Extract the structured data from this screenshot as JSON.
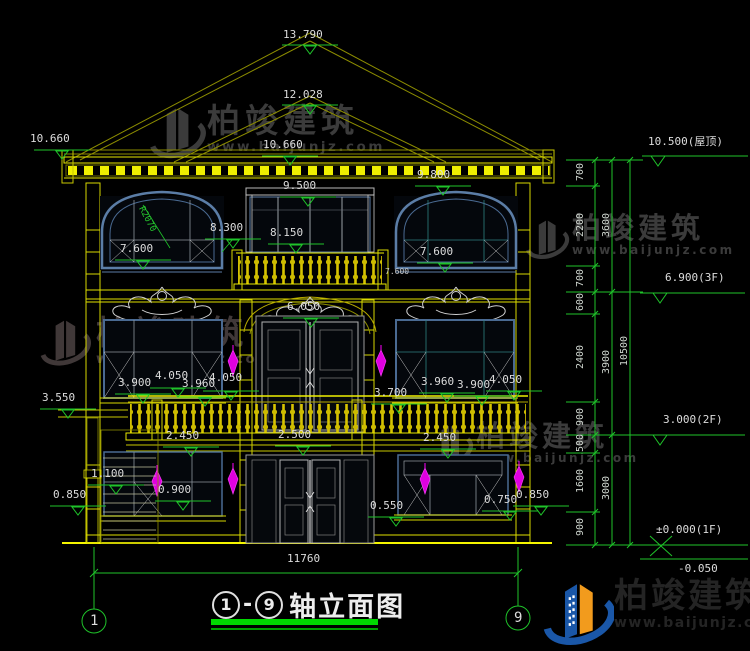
{
  "watermark": {
    "brand": "柏竣建筑",
    "url": "www.baijunjz.com"
  },
  "brand_footer": {
    "name": "柏竣建筑",
    "url": "www.baijunjz.com"
  },
  "title": {
    "axis_start": "1",
    "dash": "-",
    "axis_end": "9",
    "text": "轴立面图"
  },
  "axis_bubbles": {
    "left": "1",
    "right": "9"
  },
  "elevations": {
    "peak": "13.790",
    "ridge": "12.028",
    "eave_left": "10.660",
    "eave_center": "10.660",
    "v9800": "9.800",
    "v9500": "9.500",
    "v8300": "8.300",
    "v8150": "8.150",
    "v7600_left": "7.600",
    "v7600_right": "7.600",
    "v7600_small": "7.600",
    "v6050": "6.050",
    "radius_note": "R2070",
    "v3900_left": "3.900",
    "v4050_left": "4.050",
    "v3960_left": "3.960",
    "v4050_left2": "4.050",
    "v3700": "3.700",
    "v3960_right": "3.960",
    "v3900_right": "3.900",
    "v4050_right": "4.050",
    "v3550": "3.550",
    "v2450_left": "2.450",
    "v2500": "2.500",
    "v2450_right": "2.450",
    "v1100": "1.100",
    "v0850_left": "0.850",
    "v0900": "0.900",
    "v0550": "0.550",
    "v0750": "0.750",
    "v0850_right": "0.850"
  },
  "dimensions": {
    "overall_width": "11760",
    "right_chain": [
      "700",
      "2200",
      "700",
      "600",
      "2400",
      "900",
      "500",
      "1600",
      "900"
    ],
    "right_subtotals": [
      "3600",
      "3900",
      "3000"
    ],
    "right_total": "10500",
    "levels": {
      "roof": "10.500(屋顶)",
      "f3": "6.900(3F)",
      "f2": "3.000(2F)",
      "f1": "±0.000(1F)",
      "below": "-0.050"
    }
  }
}
